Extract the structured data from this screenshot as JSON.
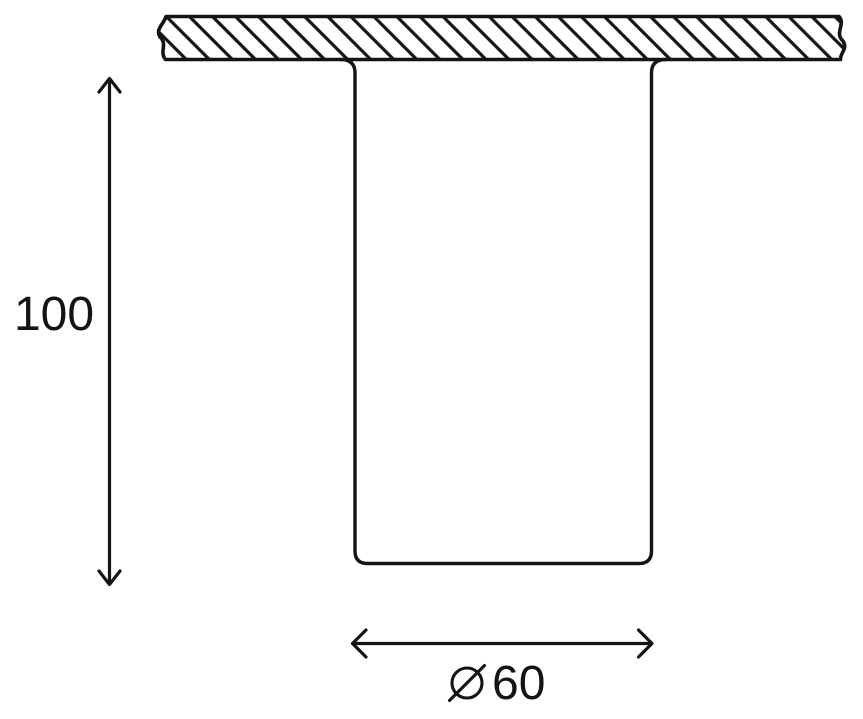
{
  "colors": {
    "background": "#ffffff",
    "ink": "#141414"
  },
  "drawing": {
    "subject": "ceiling-mounted cylindrical fixture, side elevation",
    "height_dimension": {
      "label": "100",
      "orientation": "vertical"
    },
    "diameter_dimension": {
      "label": "⌀60",
      "value": "60",
      "symbol_icon": "diameter-sign",
      "orientation": "horizontal"
    }
  }
}
